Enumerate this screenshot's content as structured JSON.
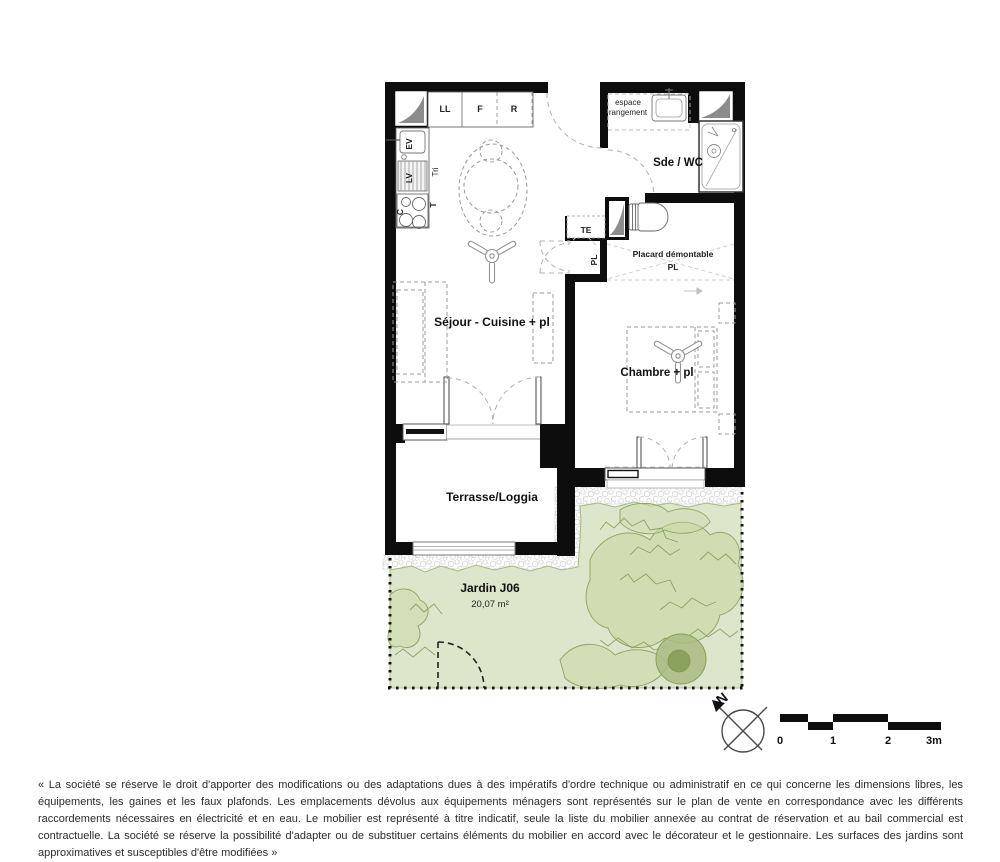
{
  "colors": {
    "wall": "#0d0d0d",
    "garden_fill": "#dde5cb",
    "garden_line": "#8aa55e",
    "bush_fill": "#ccd8a8",
    "structure_gray": "#8c8c8c"
  },
  "plan": {
    "rooms": {
      "sejour": "Séjour - Cuisine + pl",
      "chambre": "Chambre + pl",
      "sde": "Sde / WC",
      "terrasse": "Terrasse/Loggia"
    },
    "kitchen": {
      "ll": "LL",
      "f": "F",
      "r": "R",
      "ev": "EV",
      "lv": "LV",
      "c": "C",
      "tri": "Tri",
      "t": "T"
    },
    "closets": {
      "te": "TE",
      "pl": "PL",
      "placard_line1": "Placard démontable",
      "placard_line2": "PL",
      "rangement_line1": "espace",
      "rangement_line2": "rangement"
    }
  },
  "garden": {
    "name": "Jardin J06",
    "area": "20,07 m²"
  },
  "compass": {
    "north": "N"
  },
  "scalebar": {
    "t0": "0",
    "t1": "1",
    "t2": "2",
    "t3": "3m"
  },
  "disclaimer": "« La société se réserve le droit d'apporter des modifications ou des adaptations dues à des impératifs d'ordre technique ou administratif en ce qui concerne les dimensions libres, les équipements, les gaines et les faux plafonds. Les emplacements dévolus aux équipements ménagers sont représentés sur le plan de vente en correspondance avec les différents raccordements nécessaires en électricité et en eau. Le mobilier est représenté à titre indicatif, seule la liste du mobilier annexée au contrat de réservation et au bail commercial est contractuelle. La société se réserve la possibilité d'adapter ou de substituer certains éléments du mobilier en accord avec le décorateur et le gestionnaire. Les surfaces des jardins sont approximatives et susceptibles d'être modifiées »"
}
